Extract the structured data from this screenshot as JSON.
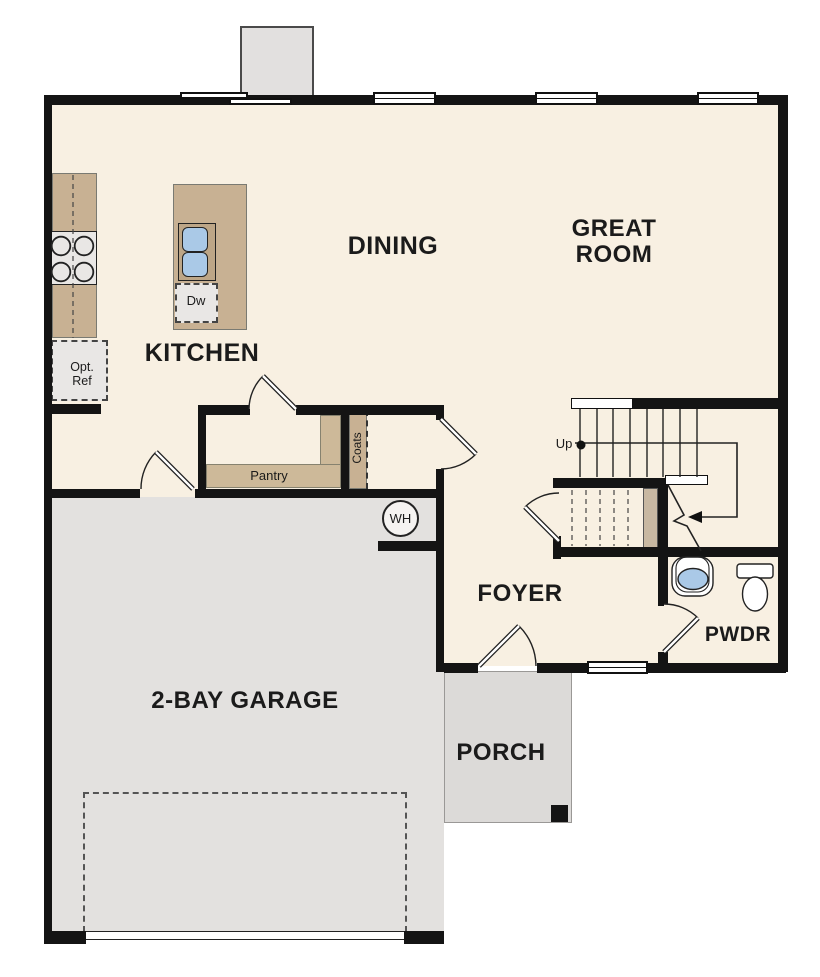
{
  "plan": {
    "rooms": {
      "kitchen": "KITCHEN",
      "dining": "DINING",
      "great_room": "GREAT\nROOM",
      "foyer": "FOYER",
      "garage": "2-BAY GARAGE",
      "porch": "PORCH",
      "powder": "PWDR"
    },
    "features": {
      "pantry": "Pantry",
      "coats": "Coats",
      "dishwasher": "Dw",
      "optional_refrigerator": "Opt.\nRef",
      "water_heater": "WH",
      "stairs_direction": "Up"
    }
  },
  "colors": {
    "wall": "#141414",
    "floor": "#f8f0e2",
    "garage_floor": "#e3e1df",
    "porch_floor": "#dcdad8",
    "counter": "#c8b193",
    "shelf": "#cdb999",
    "understair_shelf": "#c8b8a2",
    "sink_blue": "#aac9e7",
    "appliance": "#e9e7e5",
    "chimney": "#e2e0df",
    "line": "#222222",
    "text": "#1b1b1b"
  }
}
